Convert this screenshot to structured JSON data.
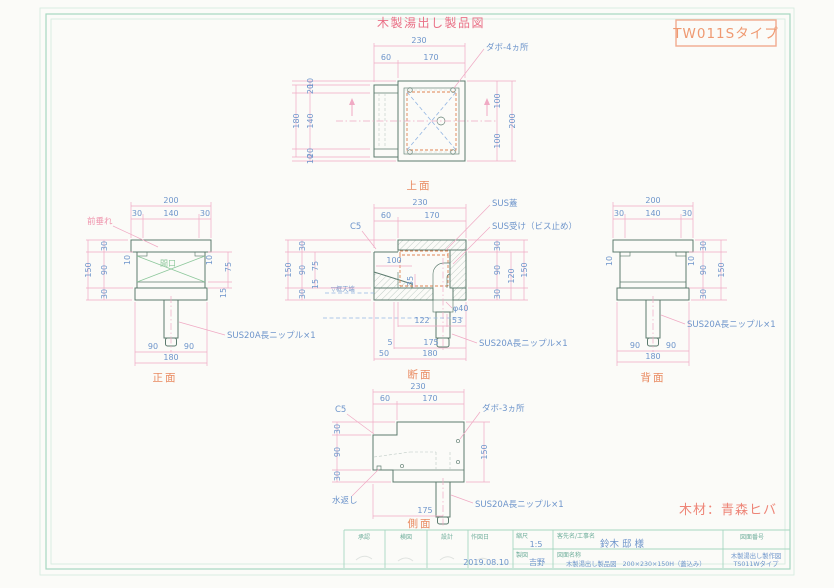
{
  "drawing": {
    "title": "木製湯出し製品図",
    "type_label": "TW011Sタイプ",
    "material": "木材：青森ヒバ"
  },
  "views": {
    "top": {
      "label": "上面",
      "w_total": "230",
      "w1": "60",
      "w2": "170",
      "l1": "10",
      "l2": "20",
      "l3": "140",
      "l4": "20",
      "l5": "10",
      "l_total": "180",
      "r1": "100",
      "r2": "100",
      "r_total": "200",
      "dowel_note": "ダボ-4ヵ所"
    },
    "front": {
      "label": "正面",
      "w_total": "200",
      "t1": "30",
      "t2": "140",
      "t3": "30",
      "h1": "30",
      "h2": "90",
      "h3": "30",
      "h_total": "150",
      "inset_l": "10",
      "inset_r": "10",
      "open_h": "75",
      "rail_h": "15",
      "b1": "90",
      "b2": "90",
      "b_total": "180",
      "apron_note": "前垂れ",
      "opening_note": "間口",
      "nipple_note": "SUS20A長ニップル×1"
    },
    "section": {
      "label": "断面",
      "w_total": "230",
      "w1": "60",
      "w2": "170",
      "chamfer_note": "C5",
      "lid_note": "SUS蓋",
      "receiver_note": "SUS受け（ビス止め）",
      "h1": "30",
      "h2": "90",
      "h3": "30",
      "h_total": "150",
      "open_h": "75",
      "rail_h": "15",
      "inner_w": "100",
      "inner_h": "35",
      "r1": "30",
      "r2": "90",
      "r3": "30",
      "r_sub": "120",
      "r_total": "150",
      "frame_note": "▽框天端",
      "dia": "φ40",
      "b1a": "122",
      "b1b": "53",
      "b2a": "5",
      "b2b": "175",
      "b3a": "50",
      "b3b": "180",
      "nipple_note": "SUS20A長ニップル×1"
    },
    "rear": {
      "label": "背面",
      "w_total": "200",
      "t1": "30",
      "t2": "140",
      "t3": "30",
      "inset_l": "10",
      "inset_r": "10",
      "r1": "30",
      "r2": "90",
      "r3": "30",
      "r_total": "150",
      "b1": "90",
      "b2": "90",
      "b_total": "180",
      "nipple_note": "SUS20A長ニップル×1"
    },
    "side": {
      "label": "側面",
      "w_total": "230",
      "w1": "60",
      "w2": "170",
      "chamfer_note": "C5",
      "dowel_note": "ダボ-3ヵ所",
      "h1": "30",
      "h2": "90",
      "h3": "30",
      "h_total": "150",
      "pipe_offset": "175",
      "drip_note": "水返し",
      "nipple_note": "SUS20A長ニップル×1"
    }
  },
  "title_block": {
    "approve_label": "承認",
    "check_label": "検図",
    "design_label": "設計",
    "date_label": "作図日",
    "date_value": "2019.08.10",
    "scale_label": "縮尺",
    "scale_value": "1:5",
    "drafter_label": "製図",
    "drafter_value": "吉野",
    "client_label": "客先名/工事名",
    "client_value": "鈴木 邸 様",
    "name_label": "図面名称",
    "name_value": "木製湯出し製品図　200×230×150H（蓋込み）",
    "no_label": "図面番号",
    "no_value1": "木製湯出し製作図",
    "no_value2": "TS011Wタイプ"
  }
}
